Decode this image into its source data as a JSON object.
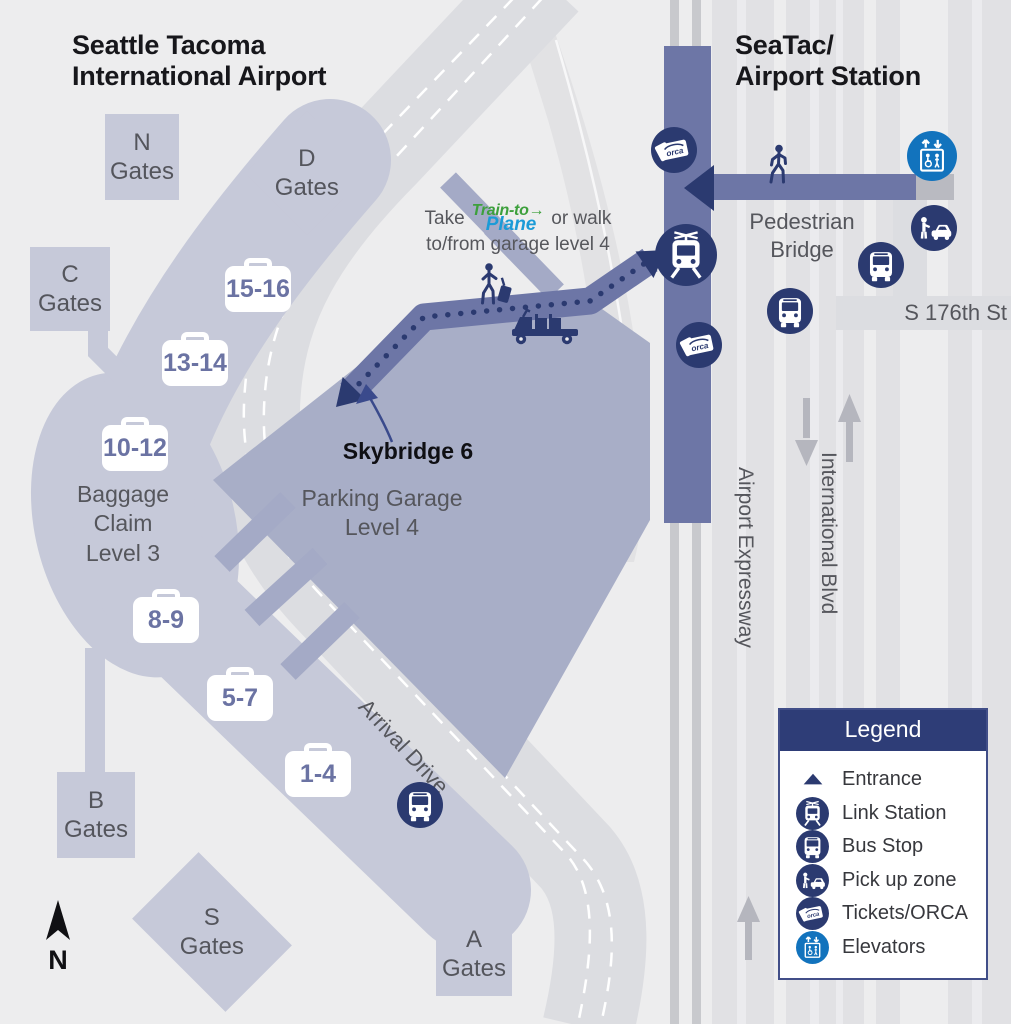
{
  "titles": {
    "airport": "Seattle Tacoma\nInternational Airport",
    "station": "SeaTac/\nAirport Station"
  },
  "gates": {
    "n": "N\nGates",
    "d": "D\nGates",
    "c": "C\nGates",
    "b": "B\nGates",
    "s": "S\nGates",
    "a": "A\nGates"
  },
  "baggage": {
    "chips": [
      "15-16",
      "13-14",
      "10-12",
      "8-9",
      "5-7",
      "1-4"
    ],
    "area_label": "Baggage\nClaim\nLevel 3"
  },
  "labels": {
    "parking_garage": "Parking Garage\nLevel 4",
    "skybridge": "Skybridge 6",
    "pedestrian_bridge": "Pedestrian\nBridge",
    "street": "S 176th St",
    "expressway": "Airport Expressway",
    "intl_blvd": "International Blvd",
    "arrival_drive": "Arrival Drive",
    "north": "N"
  },
  "note": {
    "prefix": "Take",
    "logo_line1": "Train-to→",
    "logo_line2": "Plane",
    "suffix": "or walk",
    "line2": "to/from garage level 4"
  },
  "legend": {
    "title": "Legend",
    "items": [
      {
        "icon": "entrance-icon",
        "label": "Entrance"
      },
      {
        "icon": "link-station-icon",
        "label": "Link Station"
      },
      {
        "icon": "bus-stop-icon",
        "label": "Bus Stop"
      },
      {
        "icon": "pickup-zone-icon",
        "label": "Pick up zone"
      },
      {
        "icon": "tickets-orca-icon",
        "label": "Tickets/ORCA"
      },
      {
        "icon": "elevators-icon",
        "label": "Elevators"
      }
    ]
  },
  "icons": {
    "orca_label": "orca"
  },
  "colors": {
    "background": "#ededee",
    "terminal": "#c6c9d9",
    "garage": "#a8aec7",
    "station_band": "#6d76a6",
    "navy": "#2b3a70",
    "elevator_blue": "#1273bd",
    "road": "#dcdde1",
    "train_to_green": "#3da03c",
    "plane_blue": "#1b9bd7",
    "legend_header": "#2e3d77"
  }
}
